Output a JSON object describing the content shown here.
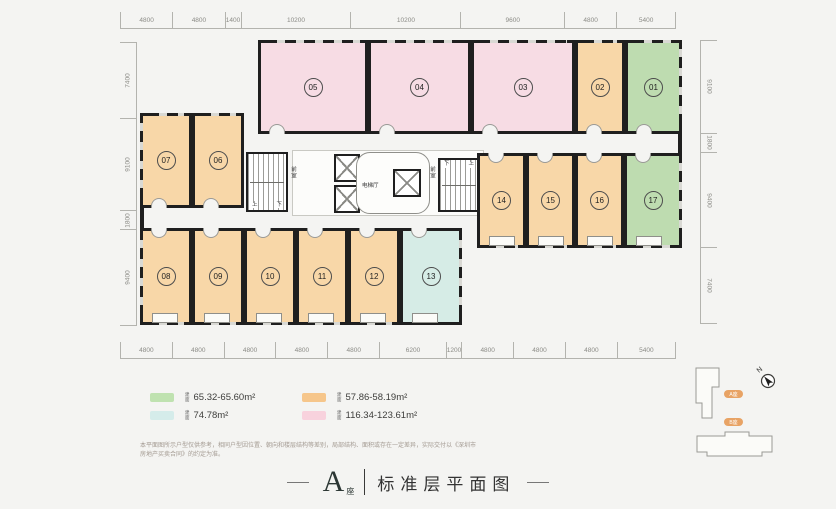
{
  "colors": {
    "wall": "#1f1f1f",
    "orange": "#f8d7a8",
    "pink": "#f7dce4",
    "green": "#bedcb0",
    "cyan": "#d6ece6",
    "orange-l": "#f6c68b",
    "pink-l": "#f8d2dd",
    "green-l": "#bfe2b0",
    "cyan-l": "#d5ecea",
    "pill": "#e8a365"
  },
  "dims": {
    "top": [
      "4800",
      "4800",
      "1400",
      "10200",
      "10200",
      "9600",
      "4800",
      "5400"
    ],
    "bottom": [
      "4800",
      "4800",
      "4800",
      "4800",
      "4800",
      "6200",
      "1200",
      "4800",
      "4800",
      "4800",
      "5400"
    ],
    "left": [
      "7400",
      "9100",
      "1800",
      "9400"
    ],
    "right": [
      "9100",
      "1800",
      "9400",
      "7400"
    ]
  },
  "rooms": {
    "r01": {
      "label": "01"
    },
    "r02": {
      "label": "02"
    },
    "r03": {
      "label": "03"
    },
    "r04": {
      "label": "04"
    },
    "r05": {
      "label": "05"
    },
    "r06": {
      "label": "06"
    },
    "r07": {
      "label": "07"
    },
    "r08": {
      "label": "08"
    },
    "r09": {
      "label": "09"
    },
    "r10": {
      "label": "10"
    },
    "r11": {
      "label": "11"
    },
    "r12": {
      "label": "12"
    },
    "r13": {
      "label": "13"
    },
    "r14": {
      "label": "14"
    },
    "r15": {
      "label": "15"
    },
    "r16": {
      "label": "16"
    },
    "r17": {
      "label": "17"
    }
  },
  "core": {
    "lobby": "电梯厅",
    "vestibule": "前室",
    "up": "上",
    "down": "下"
  },
  "legend": {
    "unit_label": "建\n面",
    "items": [
      {
        "name": "green",
        "value": "65.32-65.60m²"
      },
      {
        "name": "cyan",
        "value": "74.78m²"
      },
      {
        "name": "orange",
        "value": "57.86-58.19m²"
      },
      {
        "name": "pink",
        "value": "116.34-123.61m²"
      }
    ]
  },
  "disclaimer": "本平面图所示户型仅供参考，相同户型因位置、朝向和楼层结构等差别，局部结构、面积或存在一定差异，实际交付以《深圳市房地产买卖合同》的约定为准。",
  "title": {
    "block": "A",
    "block_suffix": "座",
    "name": "标准层平面图"
  },
  "minimap": {
    "north": "N",
    "building_a": "A座",
    "building_b": "B座"
  }
}
